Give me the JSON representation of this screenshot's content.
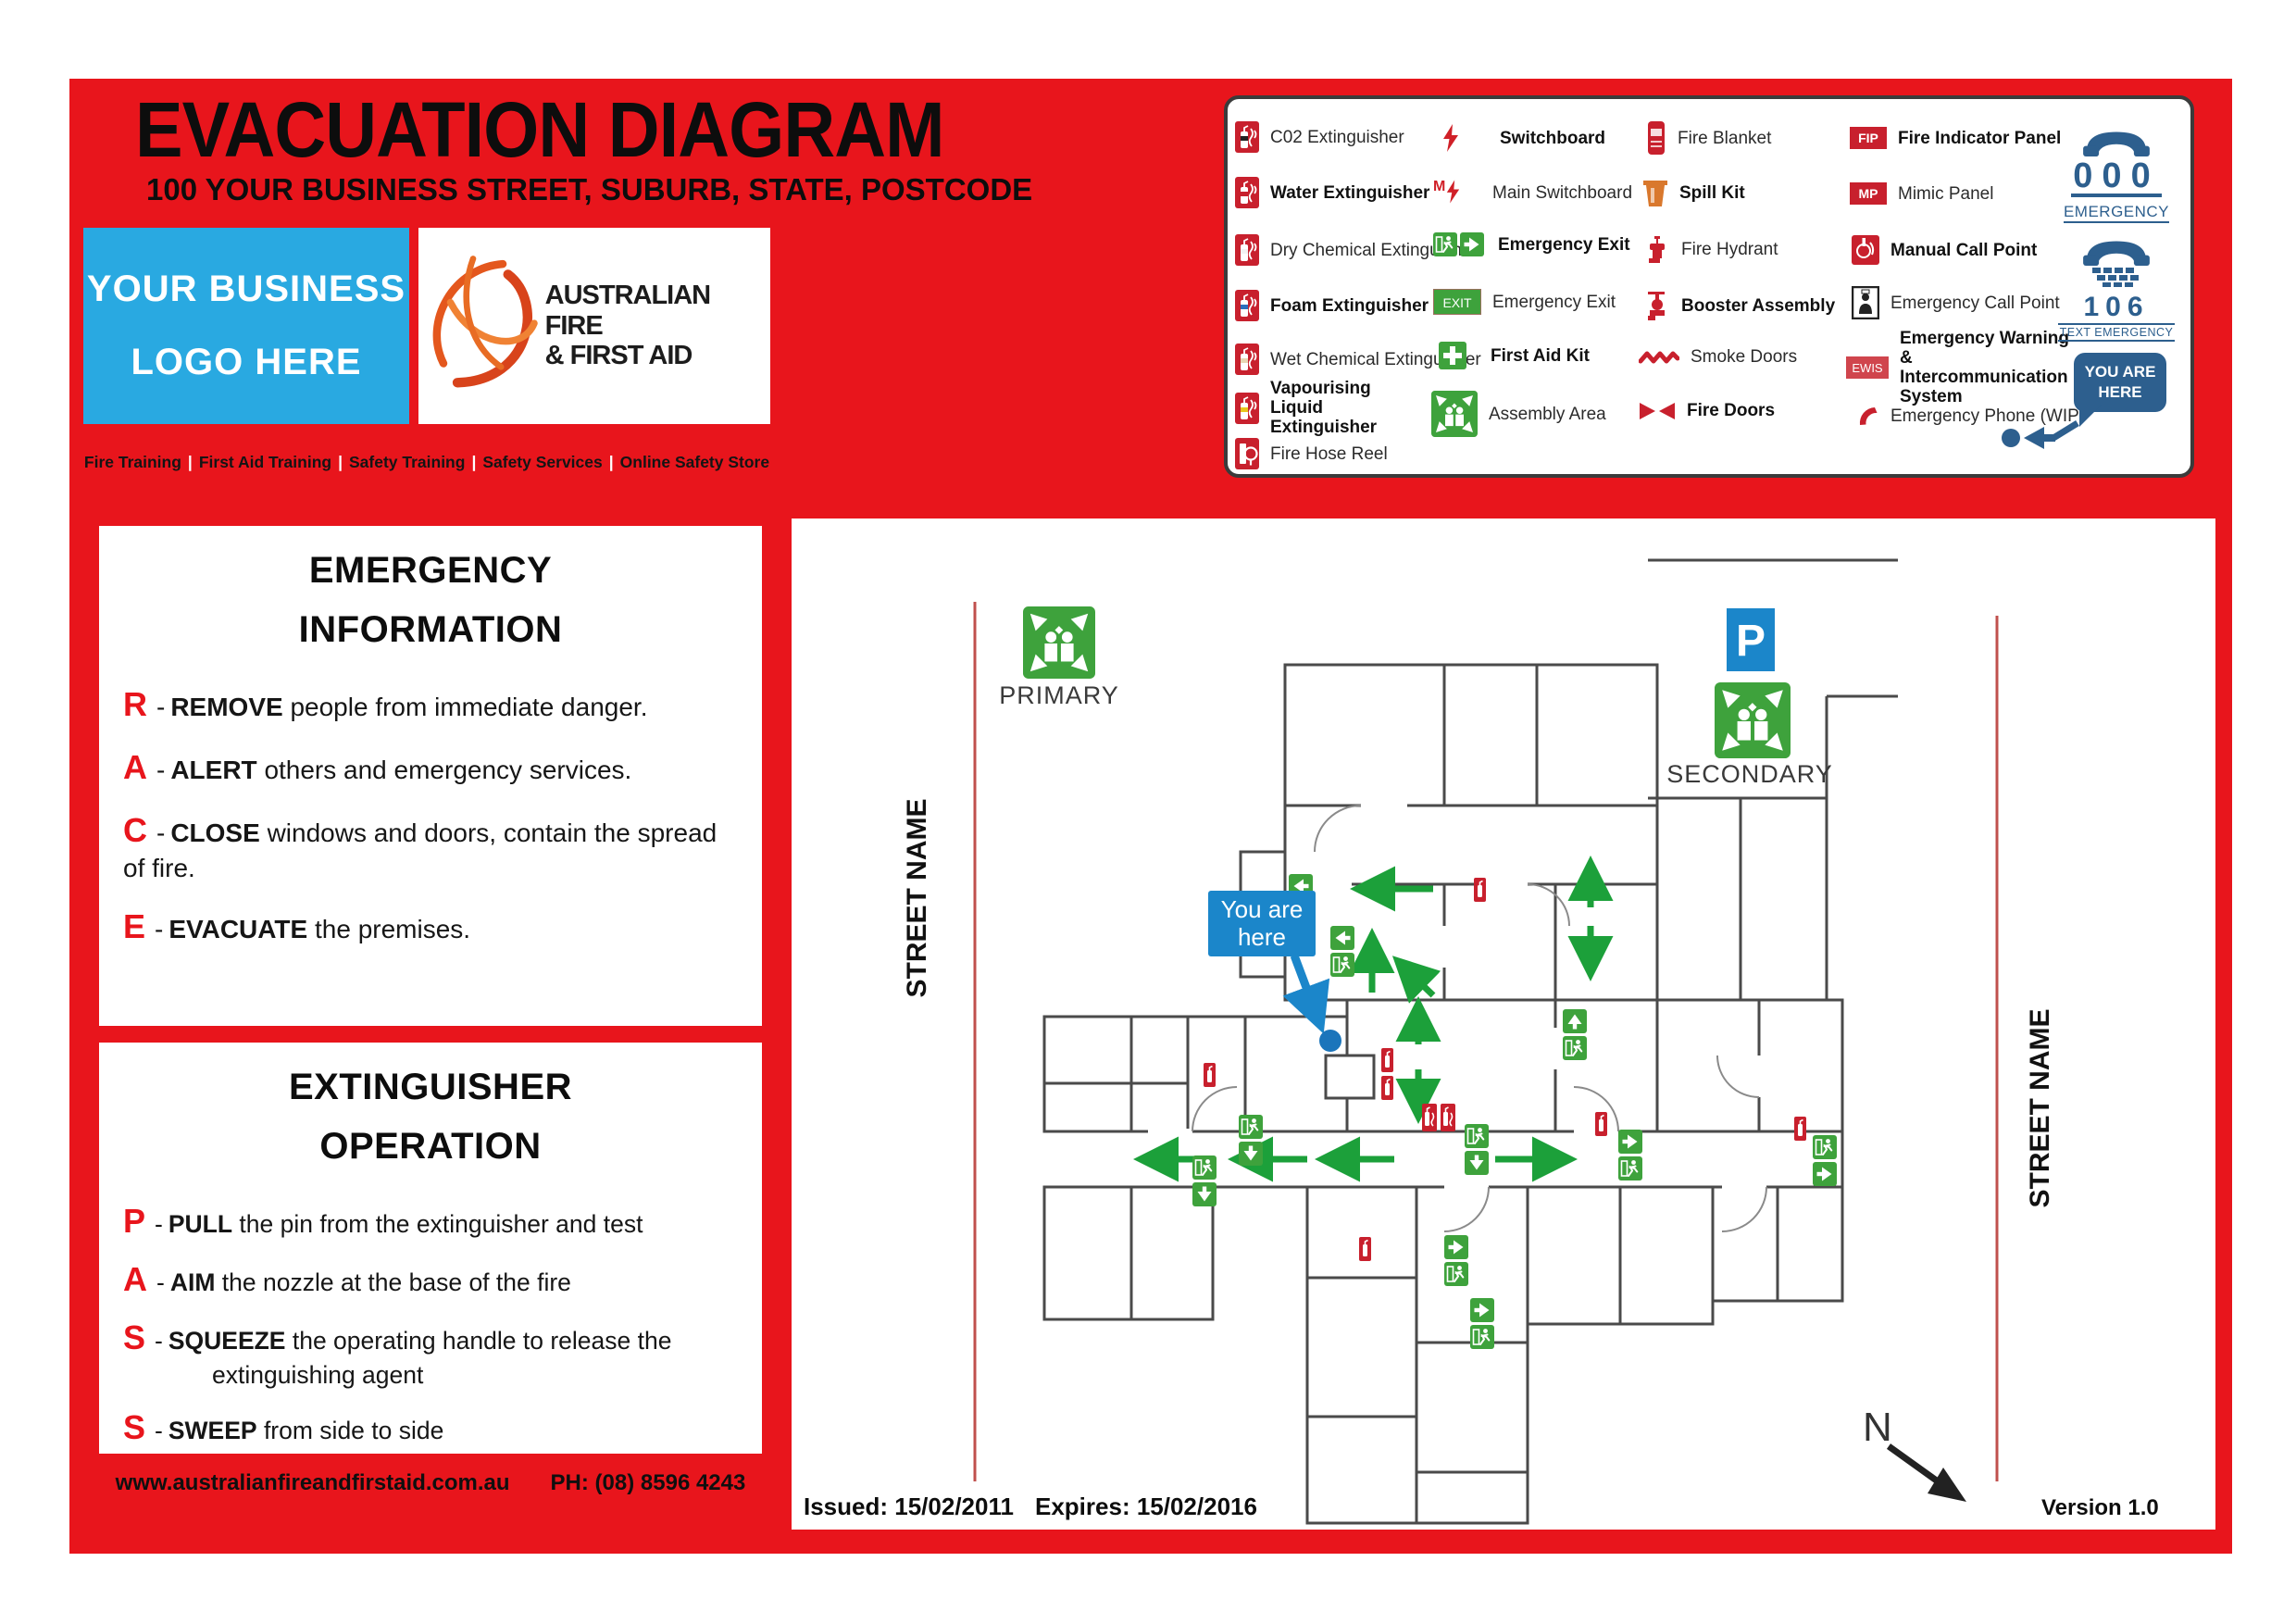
{
  "header": {
    "title": "EVACUATION DIAGRAM",
    "address": "100 YOUR BUSINESS STREET, SUBURB, STATE, POSTCODE",
    "logo_line1": "YOUR BUSINESS",
    "logo_line2": "LOGO HERE",
    "brand_line1": "AUSTRALIAN FIRE",
    "brand_line2": "& FIRST AID",
    "services": [
      "Fire Training",
      "First Aid Training",
      "Safety Training",
      "Safety Services",
      "Online Safety Store"
    ],
    "services_separator": "|"
  },
  "legend": {
    "columns": [
      {
        "items": [
          {
            "label": "C02 Extinguisher",
            "bold": false
          },
          {
            "label": "Water Extinguisher",
            "bold": true
          },
          {
            "label": "Dry Chemical Extinguisher",
            "bold": false
          },
          {
            "label": "Foam Extinguisher",
            "bold": true
          },
          {
            "label": "Wet Chemical Extinguisher",
            "bold": false
          },
          {
            "label": "Vapourising Liquid Extinguisher",
            "bold": true
          },
          {
            "label": "Fire Hose Reel",
            "bold": false
          }
        ]
      },
      {
        "items": [
          {
            "label": "Switchboard",
            "bold": true
          },
          {
            "label": "Main Switchboard",
            "bold": false
          },
          {
            "label": "Emergency Exit",
            "bold": true
          },
          {
            "label": "Emergency Exit",
            "bold": false
          },
          {
            "label": "First Aid Kit",
            "bold": true
          },
          {
            "label": "Assembly Area",
            "bold": false
          }
        ]
      },
      {
        "items": [
          {
            "label": "Fire Blanket",
            "bold": false
          },
          {
            "label": "Spill Kit",
            "bold": true
          },
          {
            "label": "Fire Hydrant",
            "bold": false
          },
          {
            "label": "Booster Assembly",
            "bold": true
          },
          {
            "label": "Smoke Doors",
            "bold": false
          },
          {
            "label": "Fire Doors",
            "bold": true
          }
        ]
      },
      {
        "items": [
          {
            "label": "Fire Indicator Panel",
            "bold": true
          },
          {
            "label": "Mimic Panel",
            "bold": false
          },
          {
            "label": "Manual Call Point",
            "bold": true
          },
          {
            "label": "Emergency Call Point",
            "bold": false
          },
          {
            "label": "Emergency Warning & Intercommunication System",
            "bold": true
          },
          {
            "label": "Emergency Phone (WIP)",
            "bold": false
          }
        ]
      }
    ],
    "icon_badges": {
      "fip": "FIP",
      "mp": "MP",
      "ewis": "EWIS",
      "exit": "EXIT",
      "m": "M"
    },
    "emergency_phone": {
      "number": "000",
      "label": "EMERGENCY"
    },
    "text_emergency_phone": {
      "number": "106",
      "label": "TEXT EMERGENCY"
    },
    "you_are_here_sign": {
      "line1": "YOU ARE",
      "line2": "HERE"
    }
  },
  "emergency_information": {
    "title_line1": "EMERGENCY",
    "title_line2": "INFORMATION",
    "items": [
      {
        "letter": "R",
        "keyword": "REMOVE",
        "text": "people from immediate danger."
      },
      {
        "letter": "A",
        "keyword": "ALERT",
        "text": "others and emergency services."
      },
      {
        "letter": "C",
        "keyword": "CLOSE",
        "text": "windows and doors, contain the spread of fire."
      },
      {
        "letter": "E",
        "keyword": "EVACUATE",
        "text": "the premises."
      }
    ]
  },
  "extinguisher_operation": {
    "title_line1": "EXTINGUISHER",
    "title_line2": "OPERATION",
    "items": [
      {
        "letter": "P",
        "keyword": "PULL",
        "text": "the pin from the extinguisher and test"
      },
      {
        "letter": "A",
        "keyword": "AIM",
        "text": "the nozzle at the base of the fire"
      },
      {
        "letter": "S",
        "keyword": "SQUEEZE",
        "text": "the operating handle to release the extinguishing agent"
      },
      {
        "letter": "S",
        "keyword": "SWEEP",
        "text": "from side to side"
      }
    ]
  },
  "footer": {
    "website": "www.australianfireandfirstaid.com.au",
    "phone": "PH: (08) 8596 4243"
  },
  "plan": {
    "street_name_left": "STREET NAME",
    "street_name_right": "STREET NAME",
    "primary_label": "PRIMARY",
    "secondary_label": "SECONDARY",
    "parking_sign": "P",
    "you_are_here_line1": "You are",
    "you_are_here_line2": "here",
    "issued": "Issued: 15/02/2011",
    "expires": "Expires: 15/02/2016",
    "version": "Version 1.0",
    "north_label": "N"
  },
  "misc": {
    "dash": "-"
  },
  "colors": {
    "page_red": "#e8151c",
    "logo_blue": "#29a9e1",
    "you_are_here_blue": "#1b86ca",
    "sign_green": "#3ea23c",
    "arrow_green": "#1ca03a",
    "marker_red": "#c8202d",
    "navy": "#2d5f8e",
    "wall_gray": "#4a4a4a",
    "street_red": "#c0504d"
  }
}
